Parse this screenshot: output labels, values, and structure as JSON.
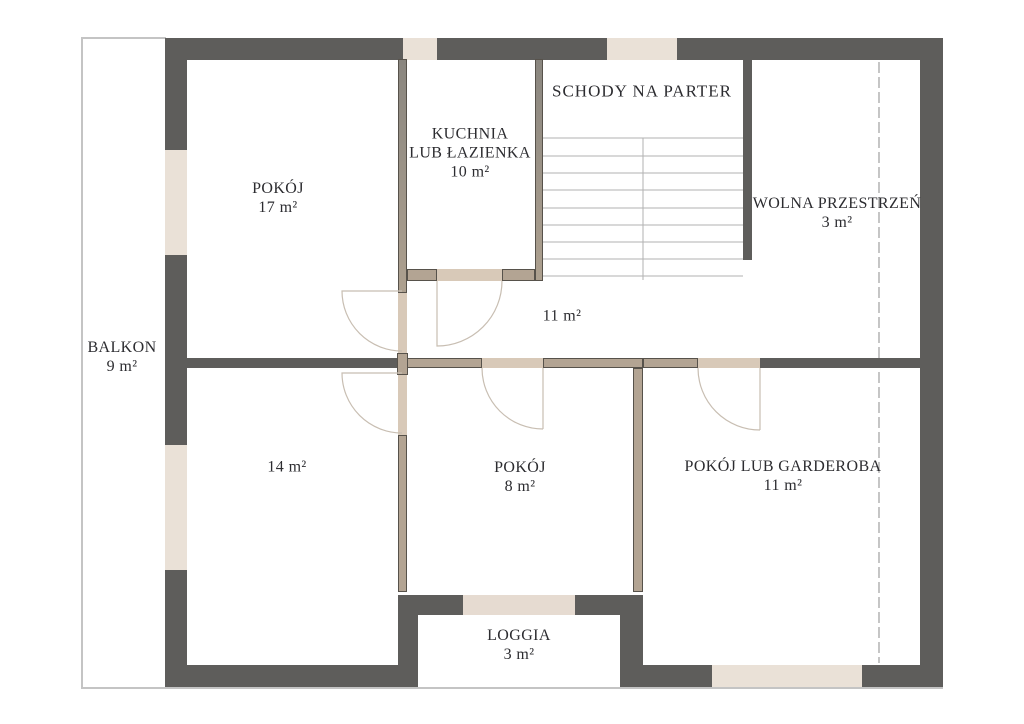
{
  "title": "Rzut piętra",
  "rooms": {
    "balkon": {
      "name": "BALKON",
      "area": "9 m²"
    },
    "pokoj17": {
      "name": "POKÓJ",
      "area": "17 m²"
    },
    "kuchnia": {
      "line1": "KUCHNIA",
      "line2": "LUB ŁAZIENKA",
      "area": "10 m²"
    },
    "schody": {
      "name": "SCHODY NA PARTER"
    },
    "wolna": {
      "name": "WOLNA PRZESTRZEŃ",
      "area": "3 m²"
    },
    "hol": {
      "area": "11 m²"
    },
    "pokoj14": {
      "area": "14 m²"
    },
    "pokoj8": {
      "name": "POKÓJ",
      "area": "8 m²"
    },
    "garderoba": {
      "name": "POKÓJ LUB GARDEROBA",
      "area": "11 m²"
    },
    "loggia": {
      "name": "LOGGIA",
      "area": "3 m²"
    }
  },
  "colors": {
    "wall_dark": "#5e5d5b",
    "wall_tan": "#b3a493",
    "wall_outline": "#57524b",
    "door_threshold": "#d8c9b8",
    "window_fill": "#eae1d7",
    "loggia_sill": "#e6dbd1",
    "stair_line": "#b2b2b2",
    "door_arc": "#c8beb2",
    "dashed_line": "#9f9f9f",
    "plan_edge": "#c4c4c4",
    "text": "#2c2c30",
    "background": "#ffffff"
  }
}
